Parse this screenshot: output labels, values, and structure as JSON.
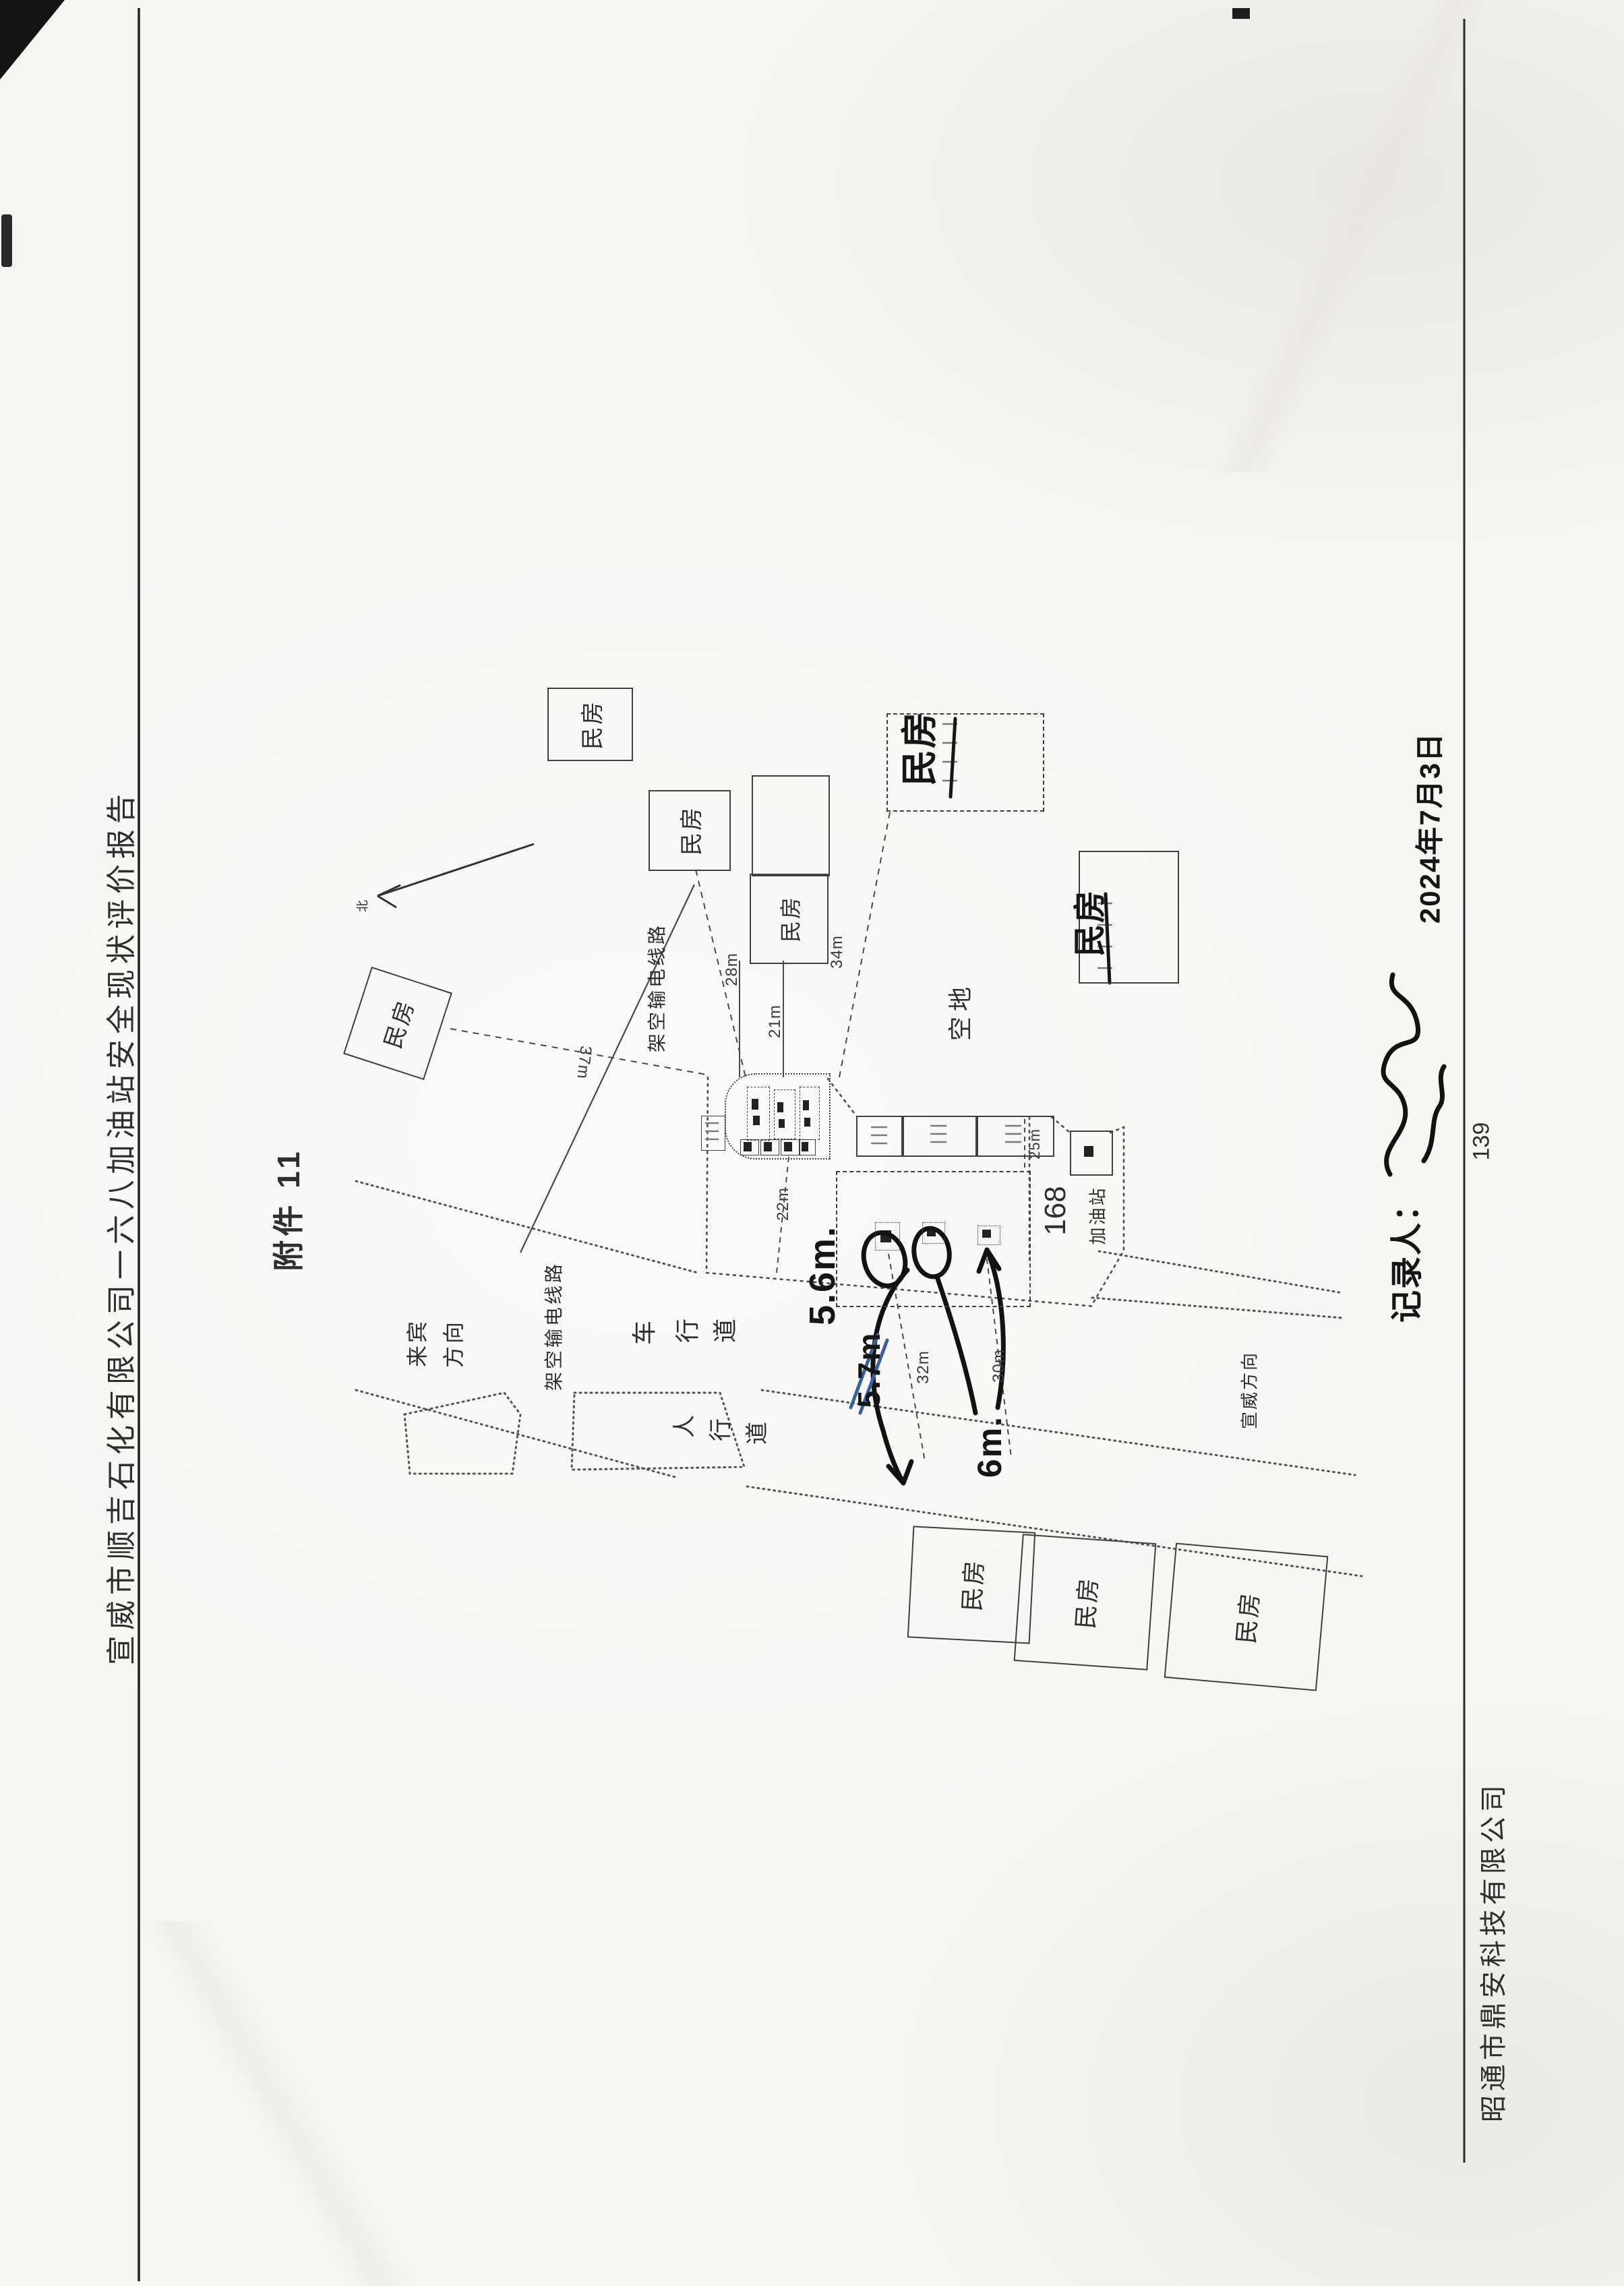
{
  "page": {
    "header_title": "宣威市顺吉石化有限公司一六八加油站安全现状评价报告",
    "attachment_label": "附件 11",
    "page_number": "139",
    "footer_company": "昭通市鼎安科技有限公司"
  },
  "diagram": {
    "north_label": "北",
    "house_label": "民房",
    "vacant_label": "空地",
    "station": {
      "number": "168",
      "name": "加油站"
    },
    "roads": {
      "direction_laibin_line1": "来宾",
      "direction_laibin_line2": "方向",
      "direction_xuanwei": "宣威方向",
      "vehicle_lane_chars": [
        "车",
        "行",
        "道"
      ],
      "sidewalk_chars": [
        "人",
        "行",
        "道"
      ],
      "powerline_label": "架空输电线路"
    },
    "dimensions": {
      "to_house_r2": "28m",
      "to_house_r3": "21m",
      "to_house_r5": "34m",
      "to_house_r4": "37m",
      "canopy_to_road": "22m",
      "road_width_left": "32m",
      "road_width_right": "30m",
      "boundary": "25m"
    },
    "handwritten": {
      "dist_1": "5.6m.",
      "dist_2": "5.7m",
      "dist_3": "6m.",
      "recorder_label": "记录人：",
      "date": "2024年7月3日"
    }
  }
}
